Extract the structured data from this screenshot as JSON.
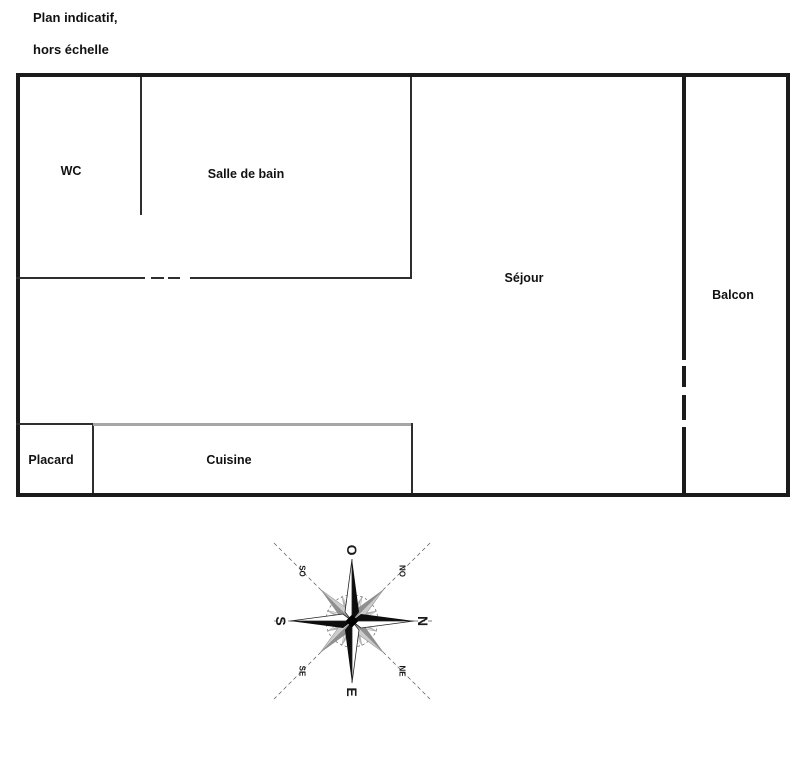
{
  "title": {
    "line1": "Plan indicatif,",
    "line2": "hors échelle"
  },
  "rooms": {
    "wc": "WC",
    "salle_de_bain": "Salle de bain",
    "sejour": "Séjour",
    "balcon": "Balcon",
    "placard": "Placard",
    "cuisine": "Cuisine"
  },
  "compass": {
    "cardinal": {
      "n": "N",
      "e": "E",
      "s": "S",
      "o": "O"
    },
    "intercardinal": {
      "ne": "NE",
      "se": "SE",
      "so": "SO",
      "no": "NO"
    }
  },
  "colors": {
    "wall": "#1b1b1b",
    "partition": "#2e2e2e",
    "kitchen_line": "#a6a6a6",
    "text": "#111111",
    "compass_dark": "#8f8f8f",
    "compass_light": "#cccccc",
    "background": "#ffffff"
  }
}
